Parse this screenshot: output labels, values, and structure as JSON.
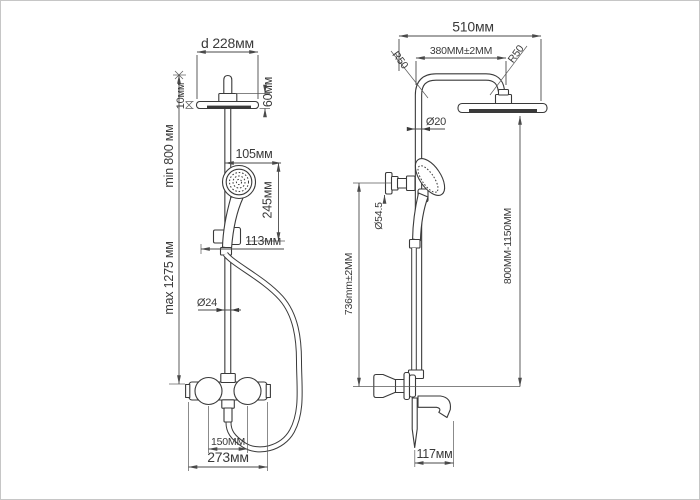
{
  "drawing": {
    "type": "technical-drawing",
    "subject": "thermostatic shower column with overhead shower, hand shower and bath spout",
    "front_view": {
      "head_diameter": "d 228мм",
      "head_thickness": "10мм",
      "head_height": "60мм",
      "hand_shower_width": "105мм",
      "hand_shower_height": "245мм",
      "holder_width": "113мм",
      "riser_min_height": "min 800 мм",
      "riser_max_height": "max 1275 мм",
      "riser_diameter": "Ø24",
      "inlet_spacing": "150MM",
      "mixer_width": "273мм"
    },
    "side_view": {
      "overall_width": "510мм",
      "arm_span": "380MM±2MM",
      "bend_radius_left": "R50",
      "bend_radius_right": "R50",
      "pipe_diameter": "Ø20",
      "bracket_diameter": "Ø54.5",
      "bracket_height": "736mm±2MM",
      "head_height_range": "800MM-1150MM",
      "spout_reach": "117мм"
    },
    "colors": {
      "line": "#3a3a3a",
      "dimension": "#4a4a4a",
      "background": "#ffffff"
    }
  }
}
